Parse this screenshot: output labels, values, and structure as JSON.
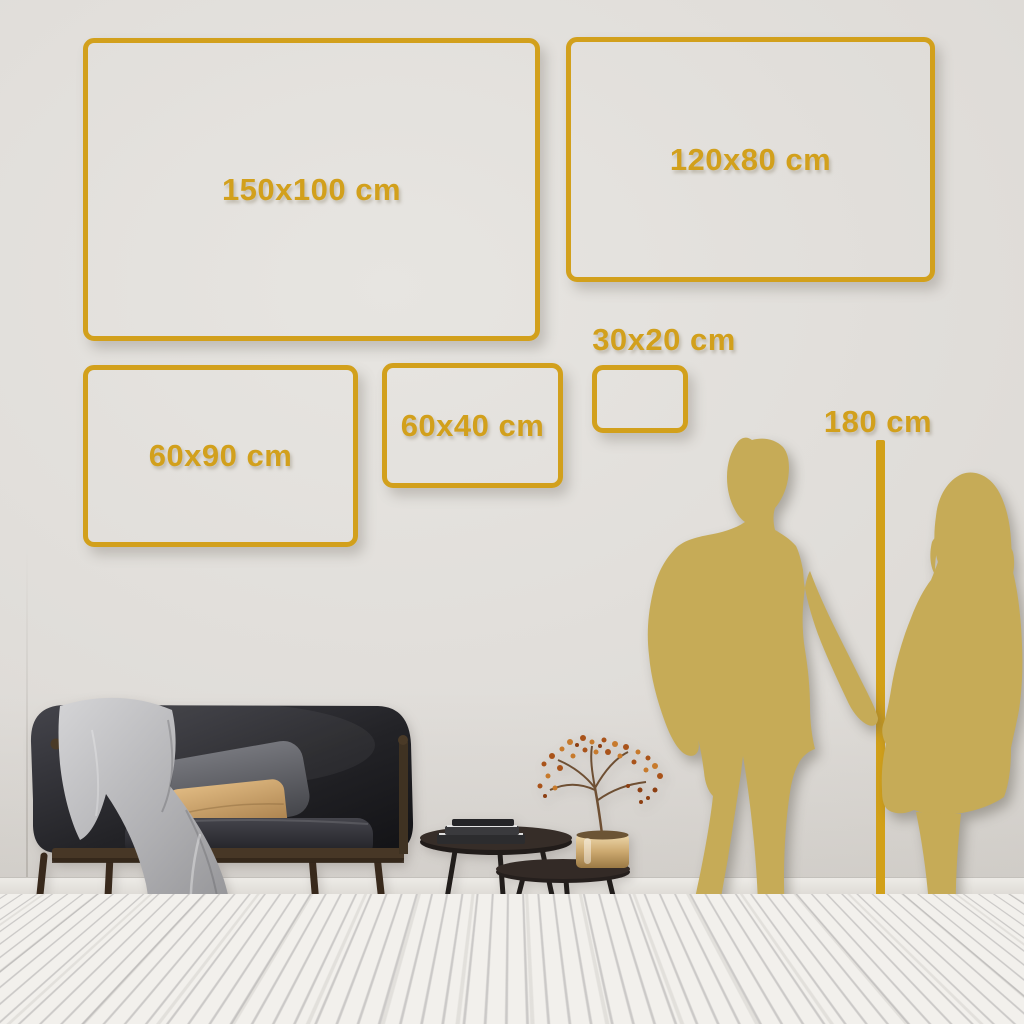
{
  "sizes": [
    {
      "label": "150x100 cm"
    },
    {
      "label": "120x80 cm"
    },
    {
      "label": "60x90 cm"
    },
    {
      "label": "60x40 cm"
    },
    {
      "label": "30x20 cm"
    }
  ],
  "reference": {
    "label": "180 cm"
  },
  "colors": {
    "frame_gold": "#D2A01C",
    "line_gold": "#D2A018",
    "silhouette_gold": "#C6AB57",
    "wall": "#DFDCD8",
    "floor": "#F1EFEB"
  },
  "scene": {
    "objects": [
      "sofa",
      "blanket",
      "gray-pillow",
      "tan-pillow",
      "nesting-coffee-tables",
      "books",
      "brass-vase",
      "dried-plant",
      "man-silhouette",
      "woman-silhouette"
    ]
  }
}
